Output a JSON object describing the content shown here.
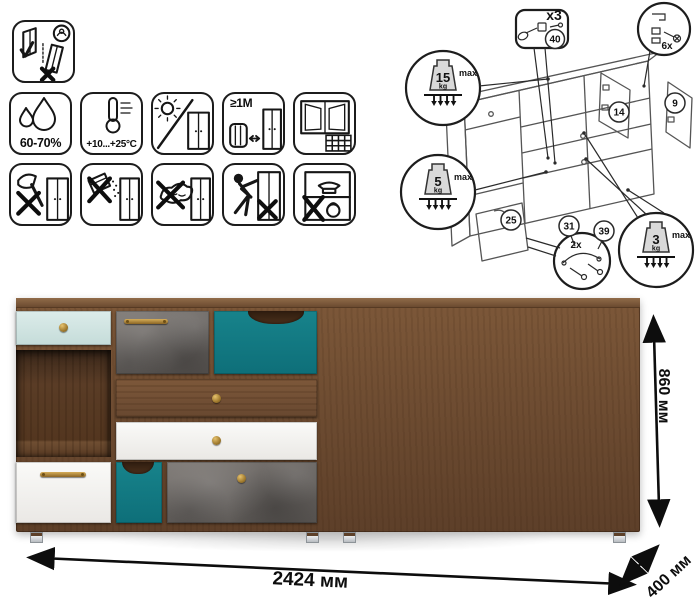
{
  "care_icons": {
    "row1": [
      {
        "icon": "carry-upright-icon"
      }
    ],
    "row2": [
      {
        "icon": "humidity-drops-icon",
        "label": "60-70%"
      },
      {
        "icon": "thermometer-icon",
        "label": "+10...+25°C"
      },
      {
        "icon": "no-direct-sunlight-icon",
        "label": ""
      },
      {
        "icon": "radiator-distance-icon",
        "label": "≥1М"
      },
      {
        "icon": "ventilation-window-icon",
        "label": ""
      }
    ],
    "row3": [
      {
        "icon": "no-sharp-tools-icon"
      },
      {
        "icon": "no-abrasive-powder-icon"
      },
      {
        "icon": "no-wet-cloth-icon"
      },
      {
        "icon": "no-leaning-icon"
      },
      {
        "icon": "no-heavy-items-icon"
      }
    ]
  },
  "assembly": {
    "multiplier": "x3",
    "parts": {
      "p40": "40",
      "p14": "14",
      "p9": "9",
      "p25": "25",
      "p31": "31",
      "p39": "39"
    },
    "counts": {
      "hinge": "6x",
      "handle": "2x"
    },
    "loads": {
      "top": {
        "value": "15",
        "unit": "kg",
        "max": "max"
      },
      "shelf": {
        "value": "5",
        "unit": "kg",
        "max": "max"
      },
      "drawer": {
        "value": "3",
        "unit": "kg",
        "max": "max"
      }
    }
  },
  "dimensions": {
    "width": "2424 мм",
    "depth": "400 мм",
    "height": "860 мм"
  },
  "furniture": {
    "colors": {
      "wood": "#6f4e34",
      "wood_dark": "#553823",
      "mint": "#cfe3e0",
      "teal": "#117c85",
      "concrete": "#6f6a66",
      "white": "#f4f3f1",
      "brass": "#b78b3e",
      "feet": "#cfd3d6"
    }
  }
}
